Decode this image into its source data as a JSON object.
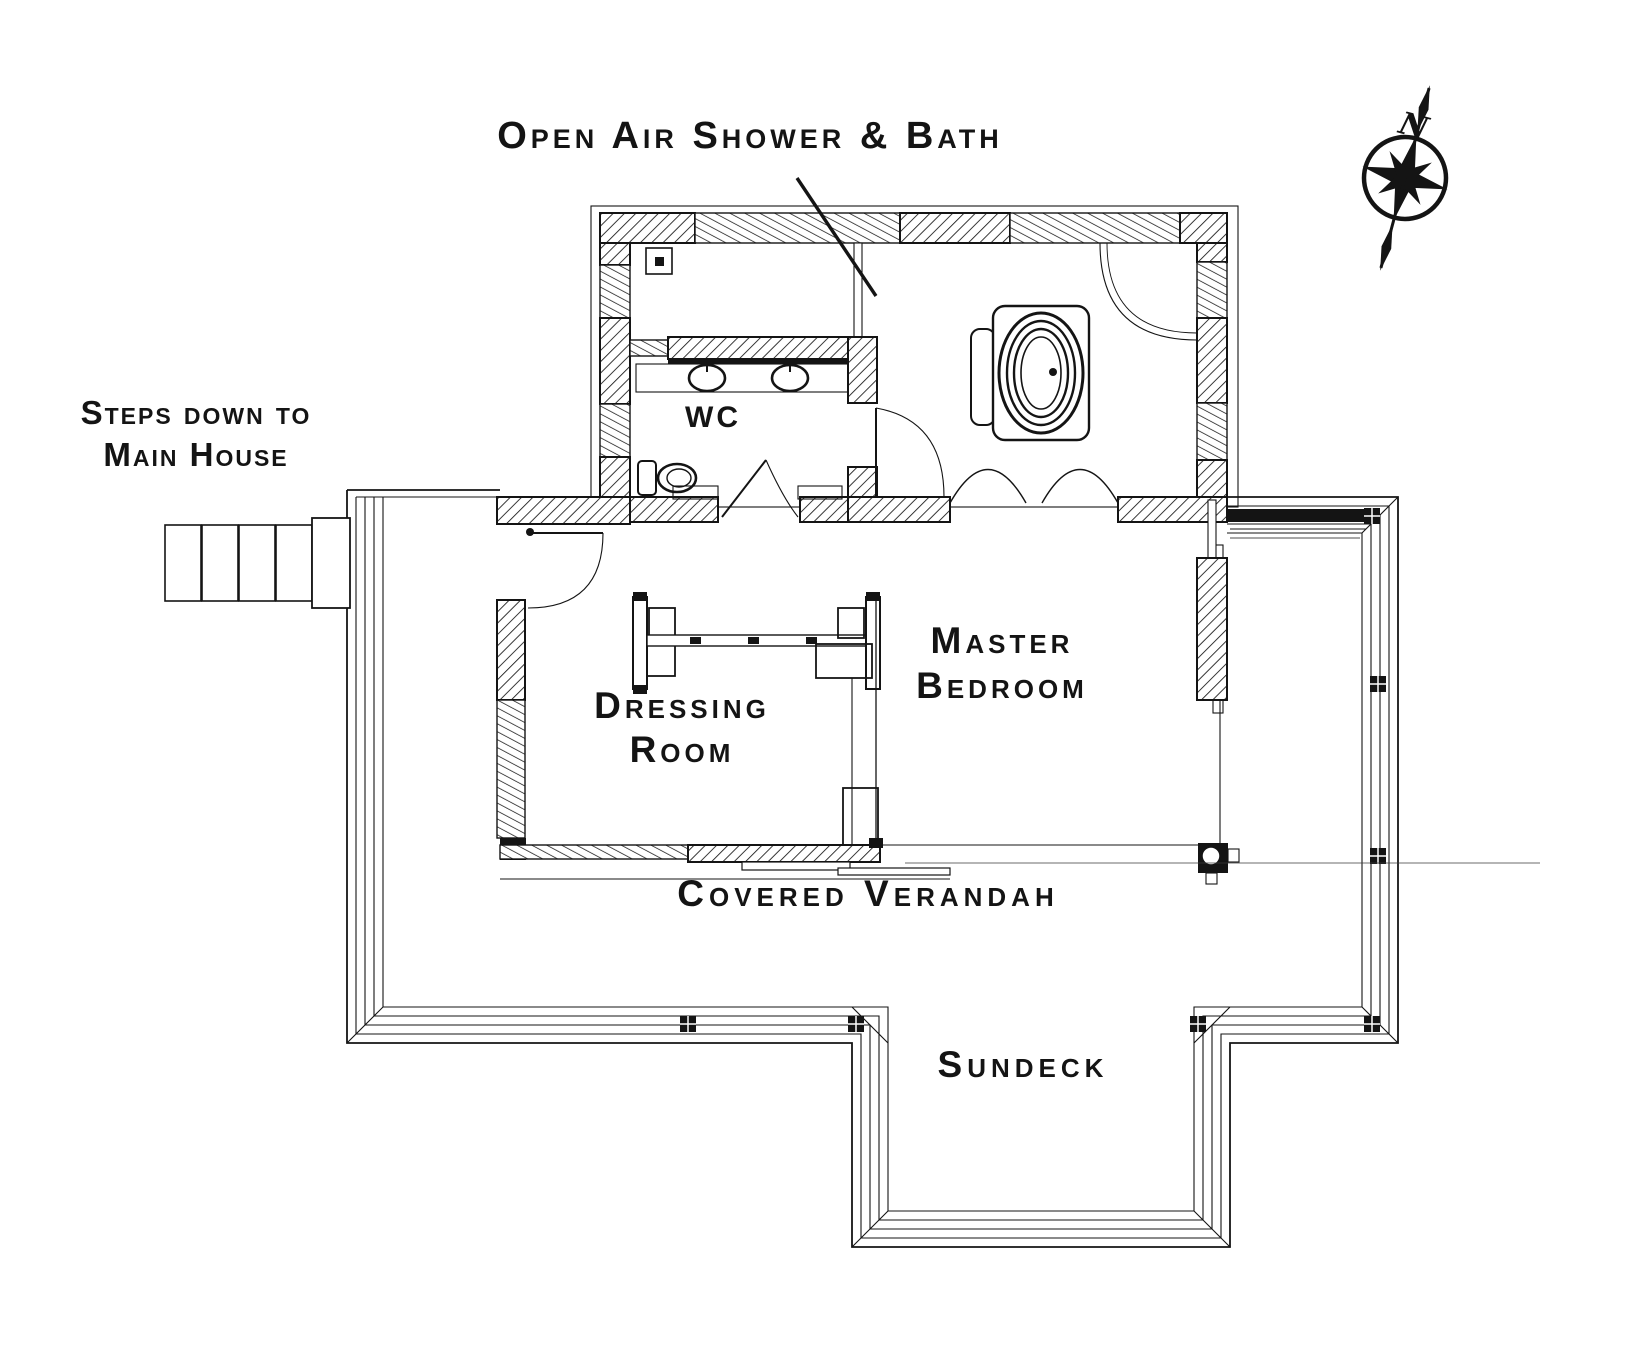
{
  "labels": {
    "title": "Open Air Shower & Bath",
    "steps_line1": "Steps down to",
    "steps_line2": "Main House",
    "wc": "WC",
    "dressing_line1": "Dressing",
    "dressing_line2": "Room",
    "master_line1": "Master",
    "master_line2": "Bedroom",
    "verandah": "Covered Verandah",
    "sundeck": "Sundeck",
    "compass_north": "N"
  },
  "colors": {
    "ink": "#141414",
    "paper": "#ffffff"
  }
}
